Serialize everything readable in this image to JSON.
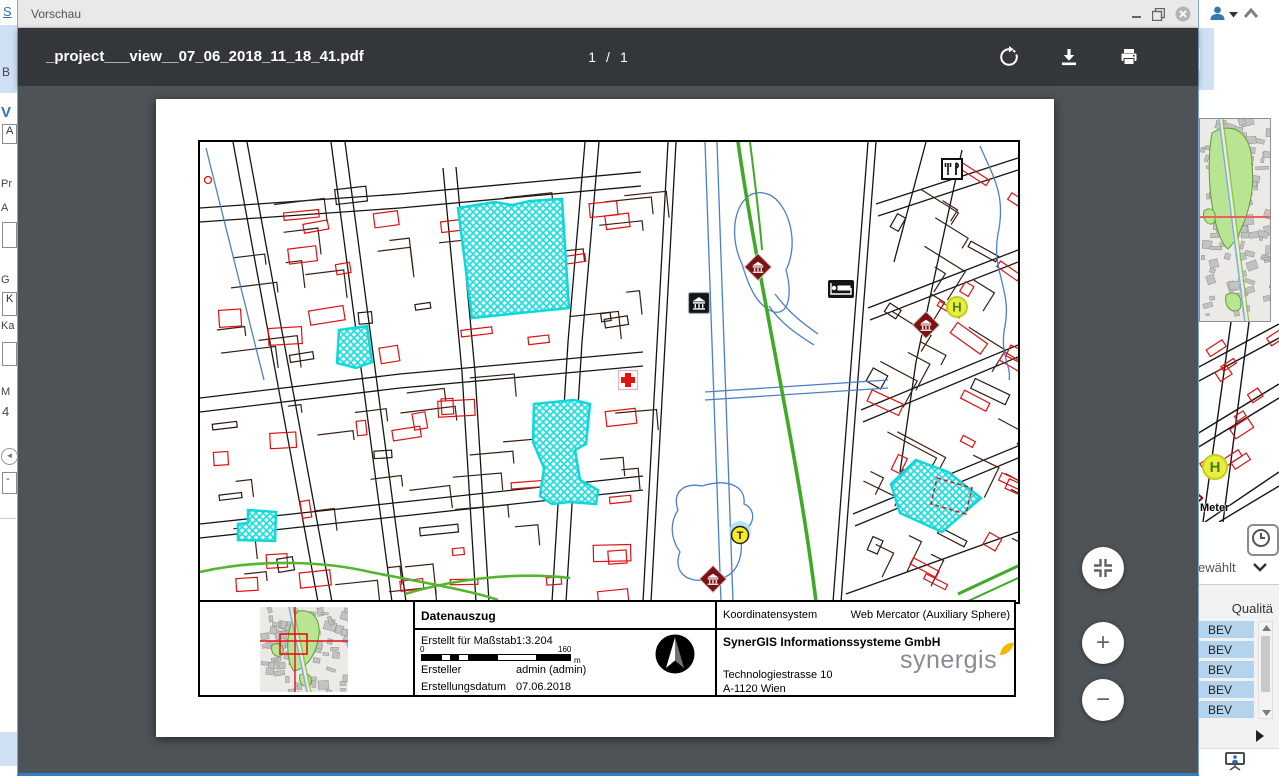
{
  "window": {
    "title": "Vorschau"
  },
  "pdf_toolbar": {
    "filename": "_project___view__07_06_2018_11_18_41.pdf",
    "page_current": "1",
    "page_separator": "/",
    "page_total": "1"
  },
  "viewer": {
    "zoom_in_label": "+",
    "zoom_out_label": "−"
  },
  "map": {
    "icon_names": [
      "restaurant-icon",
      "museum-icon",
      "hotel-icon",
      "bus-stop-icon",
      "pharmacy-cross-icon",
      "taxi-icon",
      "museum-icon",
      "museum-icon"
    ],
    "selection_color": "#1fdede"
  },
  "info_table": {
    "title": "Datenauszug",
    "scale_label": "Erstellt für Maßstab",
    "scale_value": "1:3.204",
    "scalebar_start": "0",
    "scalebar_end": "160",
    "scalebar_unit": "m",
    "creator_label": "Ersteller",
    "creator_value": "admin (admin)",
    "date_label": "Erstellungsdatum",
    "date_value": "07.06.2018",
    "crs_label": "Koordinatensystem",
    "crs_value": "Web Mercator (Auxiliary Sphere)",
    "company": "SynerGIS Informationssysteme GmbH",
    "address_line1": "Technologiestrasse 10",
    "address_line2": "A-1120 Wien",
    "logo_text": "synergis"
  },
  "background_right": {
    "meter_label": "Meter",
    "selected_label": "ewählt",
    "quality_header": "Qualitä",
    "list_items": [
      "BEV",
      "BEV",
      "BEV",
      "BEV",
      "BEV"
    ]
  },
  "background_left": {
    "fragments": [
      "S",
      "B",
      "V",
      "A",
      "Pr",
      "A",
      "G",
      "K",
      "Ka",
      "M",
      "4",
      "-"
    ]
  },
  "colors": {
    "toolbar_bg": "#33373a",
    "viewer_bg": "#4e5357",
    "titlebar_bg": "#e9e9e9",
    "selection_cyan": "#1fdede",
    "highlight_row": "#b4d3ec",
    "accent_blue": "#2e74b5"
  }
}
